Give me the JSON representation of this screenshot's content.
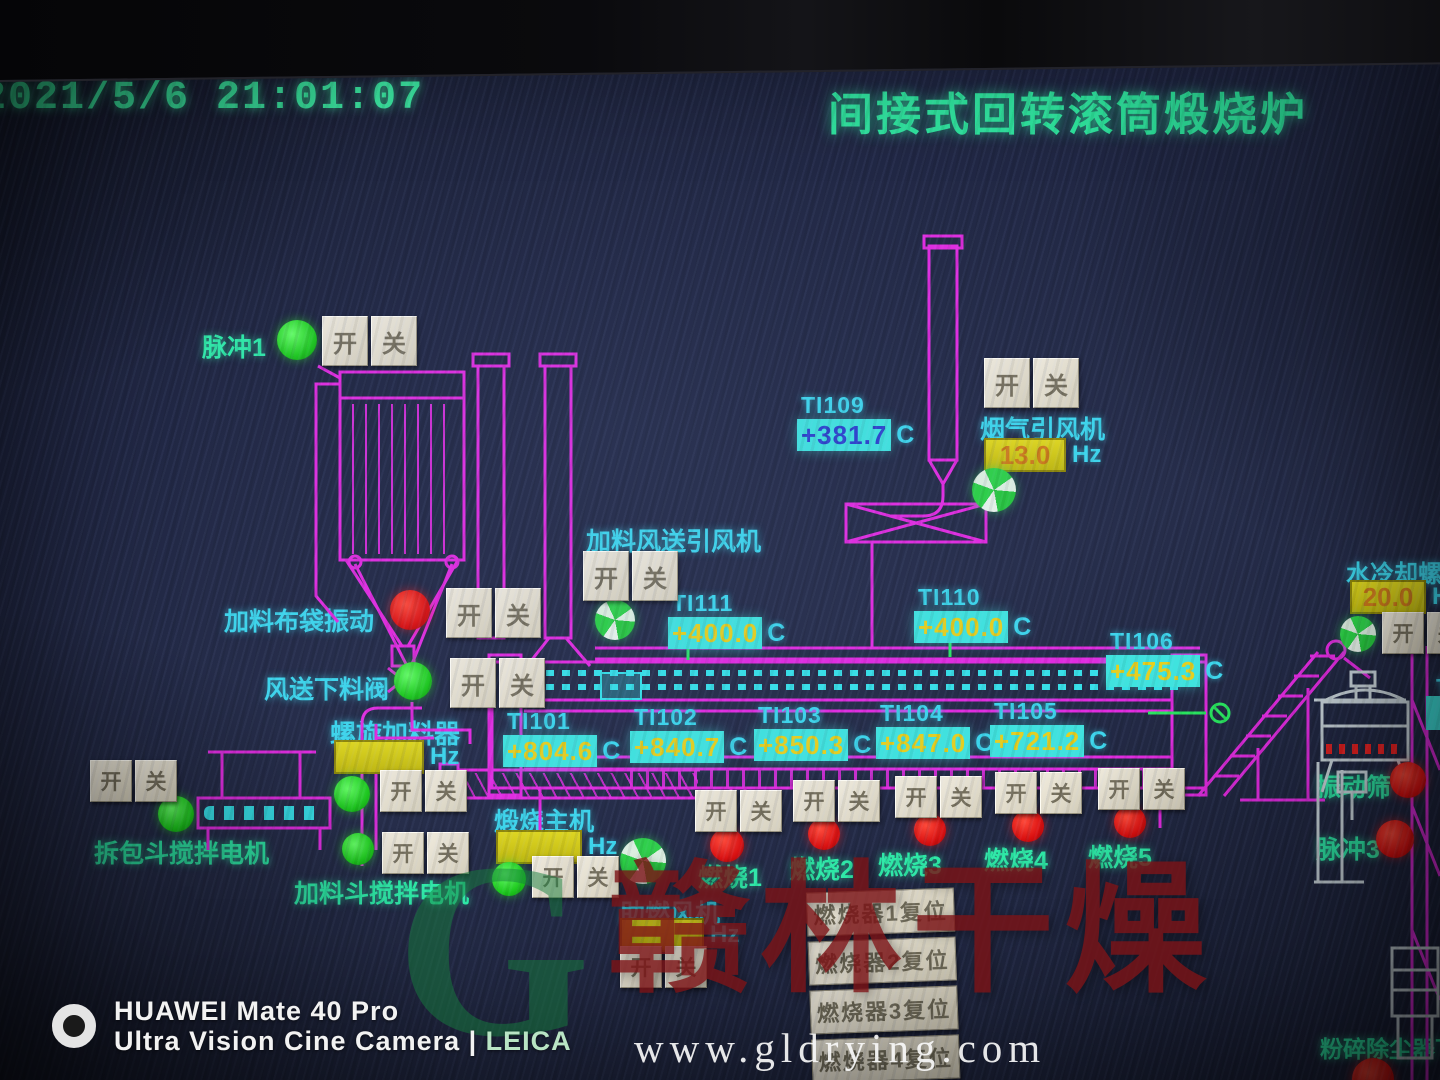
{
  "photo": {
    "timestamp": "2021/5/6  21:01:07",
    "camera_line1": "HUAWEI Mate 40 Pro",
    "camera_line2": "Ultra Vision Cine Camera | ",
    "camera_leica": "LEICA",
    "brand_watermark": "赣林干燥",
    "brand_g": "G",
    "url_watermark": "www.gldrying.com"
  },
  "header": {
    "title": "间接式回转滚筒煅烧炉"
  },
  "controls": {
    "on": "开",
    "off": "关"
  },
  "colors": {
    "label_cyan": "#3cd6ec",
    "label_teal": "#2de9a6",
    "title_green": "#2de49c",
    "piping_magenta": "#e22ae0",
    "value_box_cyan": "#3fe3de",
    "value_yellow": "#e6cf1d",
    "freq_box_yellow": "#d8d018",
    "lamp_red": "#da1010",
    "lamp_green": "#1cc81c"
  },
  "indicators": {
    "TI101": {
      "tag": "TI101",
      "value": "+804.6",
      "unit": "C"
    },
    "TI102": {
      "tag": "TI102",
      "value": "+840.7",
      "unit": "C"
    },
    "TI103": {
      "tag": "TI103",
      "value": "+850.3",
      "unit": "C"
    },
    "TI104": {
      "tag": "TI104",
      "value": "+847.0",
      "unit": "C"
    },
    "TI105": {
      "tag": "TI105",
      "value": "+721.2",
      "unit": "C"
    },
    "TI106": {
      "tag": "TI106",
      "value": "+475.3",
      "unit": "C"
    },
    "TI109": {
      "tag": "TI109",
      "value": "+381.7",
      "unit": "C"
    },
    "TI110": {
      "tag": "TI110",
      "value": "+400.0",
      "unit": "C"
    },
    "TI111": {
      "tag": "TI111",
      "value": "+400.0",
      "unit": "C"
    },
    "edge": {
      "tag": "T"
    }
  },
  "freq": {
    "flue_fan": {
      "value": "13.0",
      "unit": "Hz"
    },
    "water_screw": {
      "value": "20.0",
      "unit": "H"
    },
    "screw_feeder": {
      "value": "",
      "unit": "Hz"
    },
    "main_drum": {
      "value": "",
      "unit": "Hz"
    },
    "combustion_fan": {
      "value": "",
      "unit": "Hz"
    }
  },
  "labels": {
    "pulse1": "脉冲1",
    "flue_fan": "烟气引风机",
    "feed_air_fan": "加料风送引风机",
    "bag_vibration": "加料布袋振动",
    "air_feed_valve": "风送下料阀",
    "screw_feeder": "螺旋加料器",
    "unpack_mixer": "拆包斗搅拌电机",
    "feed_hopper_mixer": "加料斗搅拌电机",
    "main_drum": "煅烧主机",
    "combustion_fan": "助燃风机",
    "burner1": "燃烧1",
    "burner2": "燃烧2",
    "burner3": "燃烧3",
    "burner4": "燃烧4",
    "burner5": "燃烧5",
    "water_screw": "水冷却螺旋",
    "vibrating_sieve": "振动筛",
    "pulse3": "脉冲3",
    "crusher_duster": "粉碎除尘器下料"
  },
  "reset_buttons": [
    "燃烧器1复位",
    "燃烧器2复位",
    "燃烧器3复位",
    "燃烧器4复位",
    "燃烧器5复位"
  ]
}
